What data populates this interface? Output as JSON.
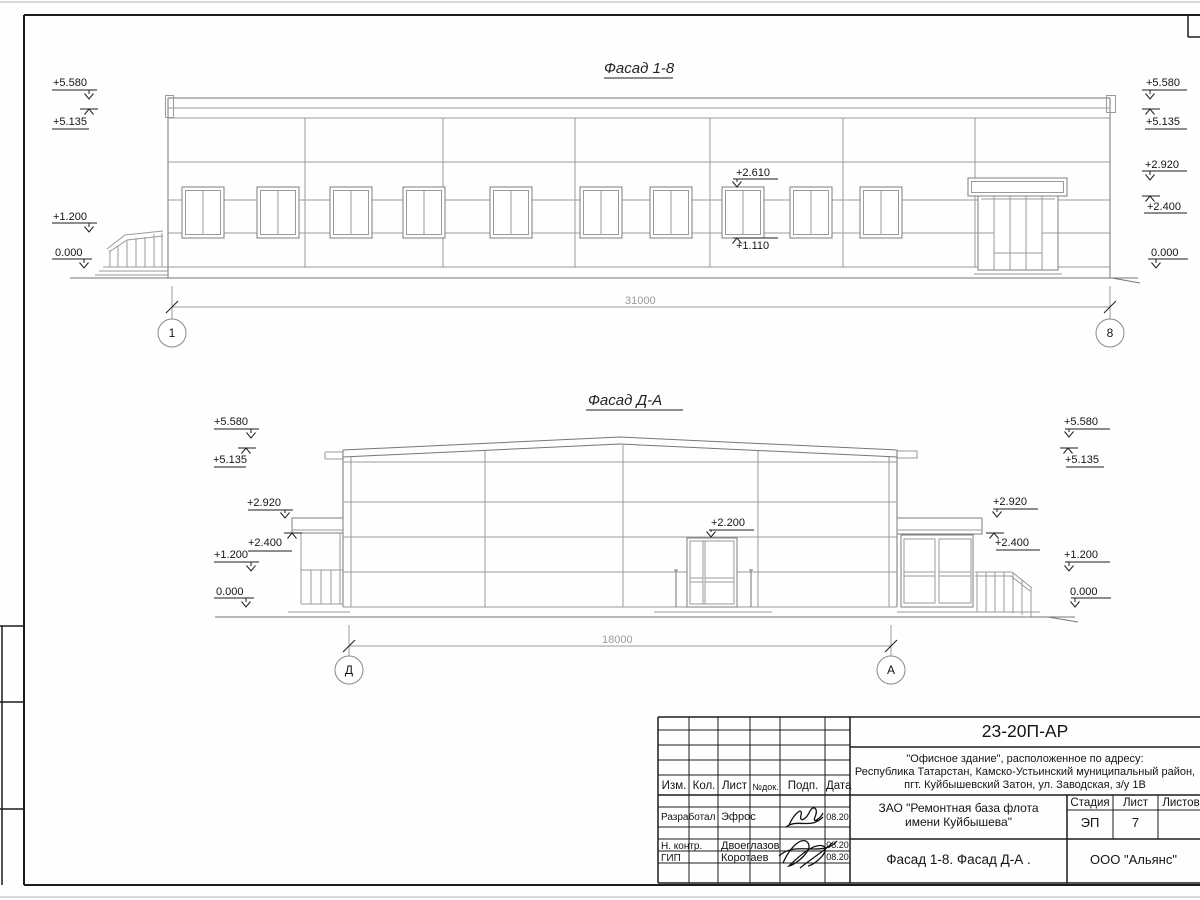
{
  "facade1": {
    "title": "Фасад 1-8",
    "dim": "31000",
    "axis_left": "1",
    "axis_right": "8",
    "mark_l1": "+5.580",
    "mark_l2": "+5.135",
    "mark_l3": "+1.200",
    "mark_l4": "0.000",
    "mark_r1": "+5.580",
    "mark_r2": "+5.135",
    "mark_r3": "+2.920",
    "mark_r4": "+2.400",
    "mark_r5": "0.000",
    "win_top": "+2.610",
    "win_bot": "+1.110"
  },
  "facade2": {
    "title": "Фасад Д-А",
    "dim": "18000",
    "axis_left": "Д",
    "axis_right": "А",
    "mark_l1": "+5.580",
    "mark_l2": "+5.135",
    "mark_l3": "+2.920",
    "mark_l4": "+2.400",
    "mark_l5": "+1.200",
    "mark_l6": "0.000",
    "mark_r1": "+5.580",
    "mark_r2": "+5.135",
    "mark_r3": "+2.920",
    "mark_r4": "+2.400",
    "mark_r5": "+1.200",
    "mark_r6": "0.000",
    "door_mark": "+2.200"
  },
  "titleblock": {
    "code": "23-20П-АР",
    "address_line1": "\"Офисное здание\", расположенное по адресу:",
    "address_line2": "Республика Татарстан, Камско-Устьинский муниципальный район,",
    "address_line3": "пгт. Куйбышевский Затон, ул. Заводская, з/у 1В",
    "client_line1": "ЗАО \"Ремонтная база флота",
    "client_line2": "имени Куйбышева\"",
    "stage_label": "Стадия",
    "sheet_label": "Лист",
    "sheets_label": "Листов",
    "stage_value": "ЭП",
    "sheet_value": "7",
    "doc_title": "Фасад 1-8. Фасад Д-А .",
    "company": "ООО \"Альянс\"",
    "columns": {
      "izm": "Изм.",
      "kol": "Кол.",
      "list": "Лист",
      "ndok": "№док.",
      "podp": "Подп.",
      "data": "Дата"
    },
    "rows": [
      {
        "role": "Разработал",
        "name": "Эфрос",
        "date": "08.20"
      },
      {
        "role": "Н. контр.",
        "name": "Двоеглазов",
        "date": "08.20"
      },
      {
        "role": "ГИП",
        "name": "Коротаев",
        "date": "08.20"
      }
    ]
  }
}
